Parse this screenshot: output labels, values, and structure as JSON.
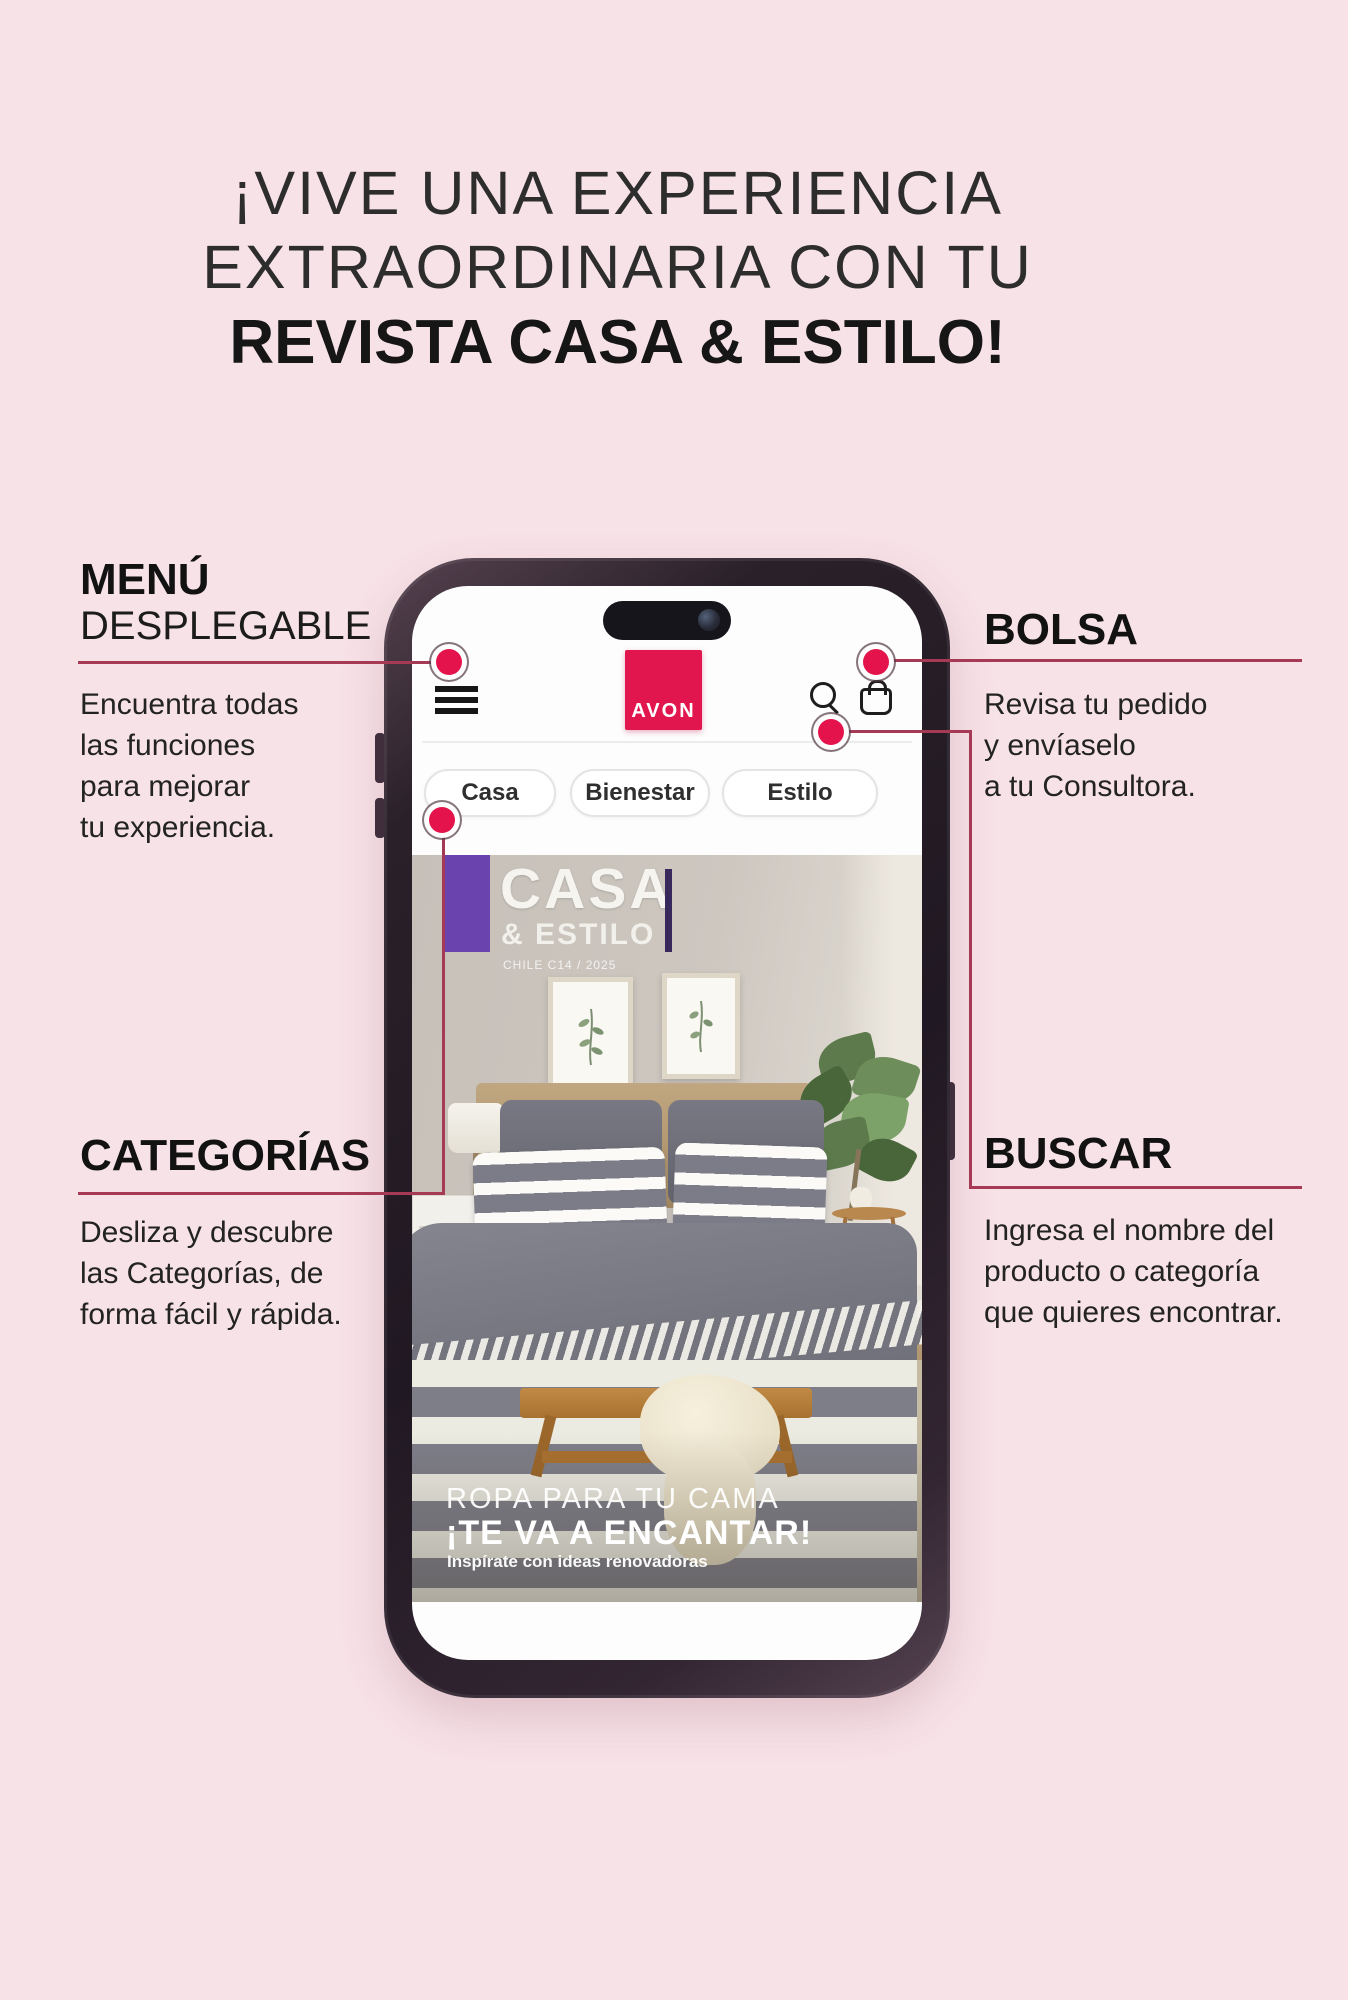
{
  "headline": {
    "line1": "¡VIVE UNA EXPERIENCIA",
    "line2": "EXTRAORDINARIA CON TU",
    "line3": "REVISTA CASA & ESTILO!"
  },
  "callouts": {
    "menu": {
      "title": "MENÚ",
      "subtitle": "DESPLEGABLE",
      "body": "Encuentra todas\nlas funciones\npara mejorar\ntu experiencia."
    },
    "bolsa": {
      "title": "BOLSA",
      "body": "Revisa tu pedido\ny envíaselo\na tu Consultora."
    },
    "categorias": {
      "title": "CATEGORÍAS",
      "body": "Desliza y descubre\nlas Categorías, de\nforma fácil y rápida."
    },
    "buscar": {
      "title": "BUSCAR",
      "body": "Ingresa el nombre del\nproducto o categoría\nque quieres encontrar."
    }
  },
  "phone": {
    "brand": "AVON",
    "header_icons": [
      "hamburger-menu-icon",
      "search-icon",
      "shopping-bag-icon"
    ],
    "tabs": [
      {
        "label": "Casa"
      },
      {
        "label": "Bienestar"
      },
      {
        "label": "Estilo"
      }
    ],
    "cover": {
      "title_line1": "CASA",
      "title_line2": "& ESTILO",
      "edition": "CHILE C14 / 2025",
      "caption_line1": "ROPA PARA TU CAMA",
      "caption_line2": "¡TE VA A ENCANTAR!",
      "caption_line3": "Inspírate con ideas renovadoras"
    }
  },
  "colors": {
    "background": "#f7e2e7",
    "connector_line": "#a63a55",
    "marker_dot": "#e5134b",
    "avon_red": "#e2164e",
    "cover_flag_purple": "#6a43ae",
    "phone_frame": "#2e2430"
  }
}
